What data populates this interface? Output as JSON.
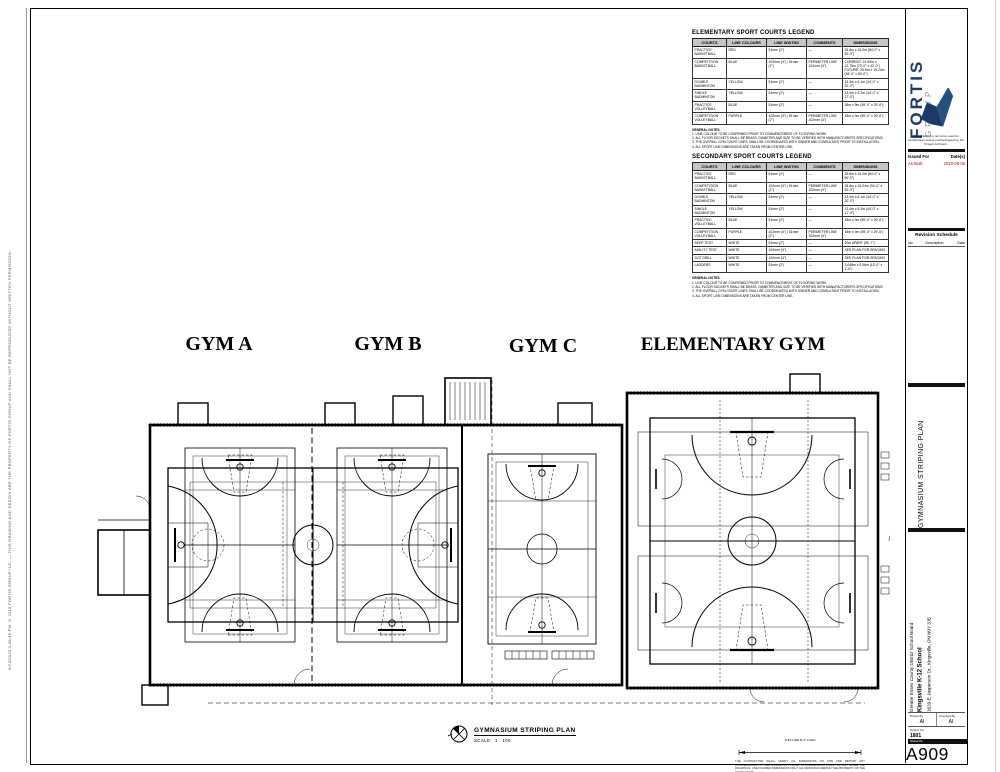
{
  "plot_stamp": "6/23/2020 2:58:45 PM     © 2019 FORTIS GROUP INC. — THIS DRAWING AND DESIGN ARE THE PROPERTY OF FORTIS GROUP AND SHALL NOT BE REPRODUCED WITHOUT WRITTEN PERMISSION.",
  "legends": {
    "columns": [
      "COURTS",
      "LINE COLOURS",
      "LINE WIDTHS",
      "COMMENTS",
      "DIMENSIONS"
    ],
    "elementary": {
      "title": "ELEMENTARY SPORT COURTS LEGEND",
      "rows": [
        [
          "PRACTICE BASKETBALL",
          "RED",
          "51mm (2\")",
          "—",
          "25.6m x 15.2m (84'-0\" x 50'-0\")"
        ],
        [
          "COMPETITION BASKETBALL",
          "BLUE",
          "102mm (4\") / 51mm (2\")",
          "PERIMETER LINE 102mm (4\")",
          "CURRENT: 21.94m x 12.75m (72'-0\" x 42'-0\") FUTURE: 25.6m x 15.24m (84'-0\" x 50'-0\")"
        ],
        [
          "DOUBLE BADMINTON",
          "YELLOW",
          "51mm (2\")",
          "—",
          "13.4m x 6.1m (44'-0\" x 20'-0\")"
        ],
        [
          "SINGLE BADMINTON",
          "YELLOW",
          "51mm (2\")",
          "—",
          "13.4m x 5.2m (44'-0\" x 17'-0\")"
        ],
        [
          "PRACTICE VOLLEYBALL",
          "BLUE",
          "51mm (2\")",
          "—",
          "18m x 9m (59'-0\" x 29'-6\")"
        ],
        [
          "COMPETITION VOLLEYBALL",
          "PURPLE",
          "102mm (4\") / 51mm (2\")",
          "PERIMETER LINE 102mm (4\")",
          "18m x 9m (59'-0\" x 29'-6\")"
        ]
      ]
    },
    "secondary": {
      "title": "SECONDARY SPORT COURTS LEGEND",
      "rows": [
        [
          "PRACTICE BASKETBALL",
          "RED",
          "51mm (2\")",
          "—",
          "25.6m x 15.2m (84'-0\" x 50'-0\")"
        ],
        [
          "COMPETITION BASKETBALL",
          "BLUE",
          "102mm (4\") / 51mm (2\")",
          "PERIMETER LINE 102mm (4\")",
          "28.6m x 15.24m (94'-0\" x 50'-0\")"
        ],
        [
          "DOUBLE BADMINTON",
          "YELLOW",
          "51mm (2\")",
          "—",
          "13.4m x 6.1m (44'-0\" x 20'-0\")"
        ],
        [
          "SINGLE BADMINTON",
          "YELLOW",
          "51mm (2\")",
          "—",
          "13.4m x 5.2m (44'-0\" x 17'-0\")"
        ],
        [
          "PRACTICE VOLLEYBALL",
          "BLUE",
          "51mm (2\")",
          "—",
          "18m x 9m (59'-0\" x 29'-6\")"
        ],
        [
          "COMPETITION VOLLEYBALL",
          "PURPLE",
          "102mm (4\") / 51mm (2\")",
          "PERIMETER LINE 102mm (4\")",
          "18m x 9m (59'-0\" x 29'-6\")"
        ],
        [
          "BEEP TEST",
          "WHITE",
          "51mm (2\")",
          "—",
          "20m APART (65'-7\")"
        ],
        [
          "AGILITY TEST",
          "WHITE",
          "102mm (4\")",
          "—",
          "SEE PLAN FOR SPACING"
        ],
        [
          "DOT DRILL",
          "WHITE",
          "102mm (4\")",
          "—",
          "SEE PLAN FOR SPACING"
        ],
        [
          "LADDERS",
          "WHITE",
          "51mm (2\")",
          "—",
          "3.048m x 0.46m (10'-0\" x 1'-6\")"
        ]
      ]
    },
    "general_notes_title": "GENERAL NOTES:",
    "general_notes": [
      "1. LINE COLOUR TO BE CONFIRMED PRIOR TO COMMENCEMENT OF FLOORING WORK.",
      "2. ALL FLOOR SOCKETS SHALL BE BRASS. DIAMETER AND SIZE TO BE VERIFIED WITH MANUFACTURER'S SPECIFICATIONS.",
      "3. THE OVERALL GYM COURT LINES SHALL BE COORDINATED WITH OWNER AND CONSULTANT PRIOR TO INSTALLATION.",
      "4. ALL SPORT LINE DIMENSIONS ARE TAKEN FROM CENTER LINE."
    ]
  },
  "gym_labels": [
    "GYM A",
    "GYM B",
    "GYM C",
    "ELEMENTARY GYM"
  ],
  "drawing_title": {
    "name": "GYMNASIUM STRIPING PLAN",
    "scale_label": "SCALE:",
    "scale_value": "1 : 100"
  },
  "scale_check": {
    "bar_label": "THIS LINE IS 3\" LONG",
    "note": "THE CONTRACTOR SHALL VERIFY ALL DIMENSIONS ON SITE AND REPORT ANY DISCREPANCIES TO THE CONSULTANT PRIOR TO COMMENCING WORK. DO NOT SCALE THE DRAWINGS. USE FIGURED DIMENSIONS ONLY. ALL DRAWINGS REMAIN THE PROPERTY OF THE CONSULTANT."
  },
  "titleblock": {
    "firm_name": "FORTIS",
    "firm_sub": "GROUP",
    "disclaimer": "This drawing is not to be used for construction unless countersigned by the Project Architect.",
    "issued_for_label": "Issued For",
    "dates_label": "Date(s)",
    "issued_rows": [
      {
        "issued": "As-Built",
        "date": "2020-08-06"
      }
    ],
    "revision_title": "Revision Schedule",
    "revision_columns": [
      "No.",
      "Description",
      "Date"
    ],
    "sheet_title": "GYMNASIUM STRIPING PLAN",
    "client": "Greater Essex County District School Board",
    "project": "Kingsville K-12 School",
    "address": "1620-E Jasperson Dr., Kingsville, ON N9Y 3J5",
    "drawn_by_label": "Drawn By",
    "drawn_by": "AI",
    "checked_by_label": "Checked By",
    "checked_by": "AI",
    "project_no_label": "Project No.",
    "project_no": "1801",
    "sheet_no_label": "Sheet No.",
    "sheet_no": "A909"
  }
}
